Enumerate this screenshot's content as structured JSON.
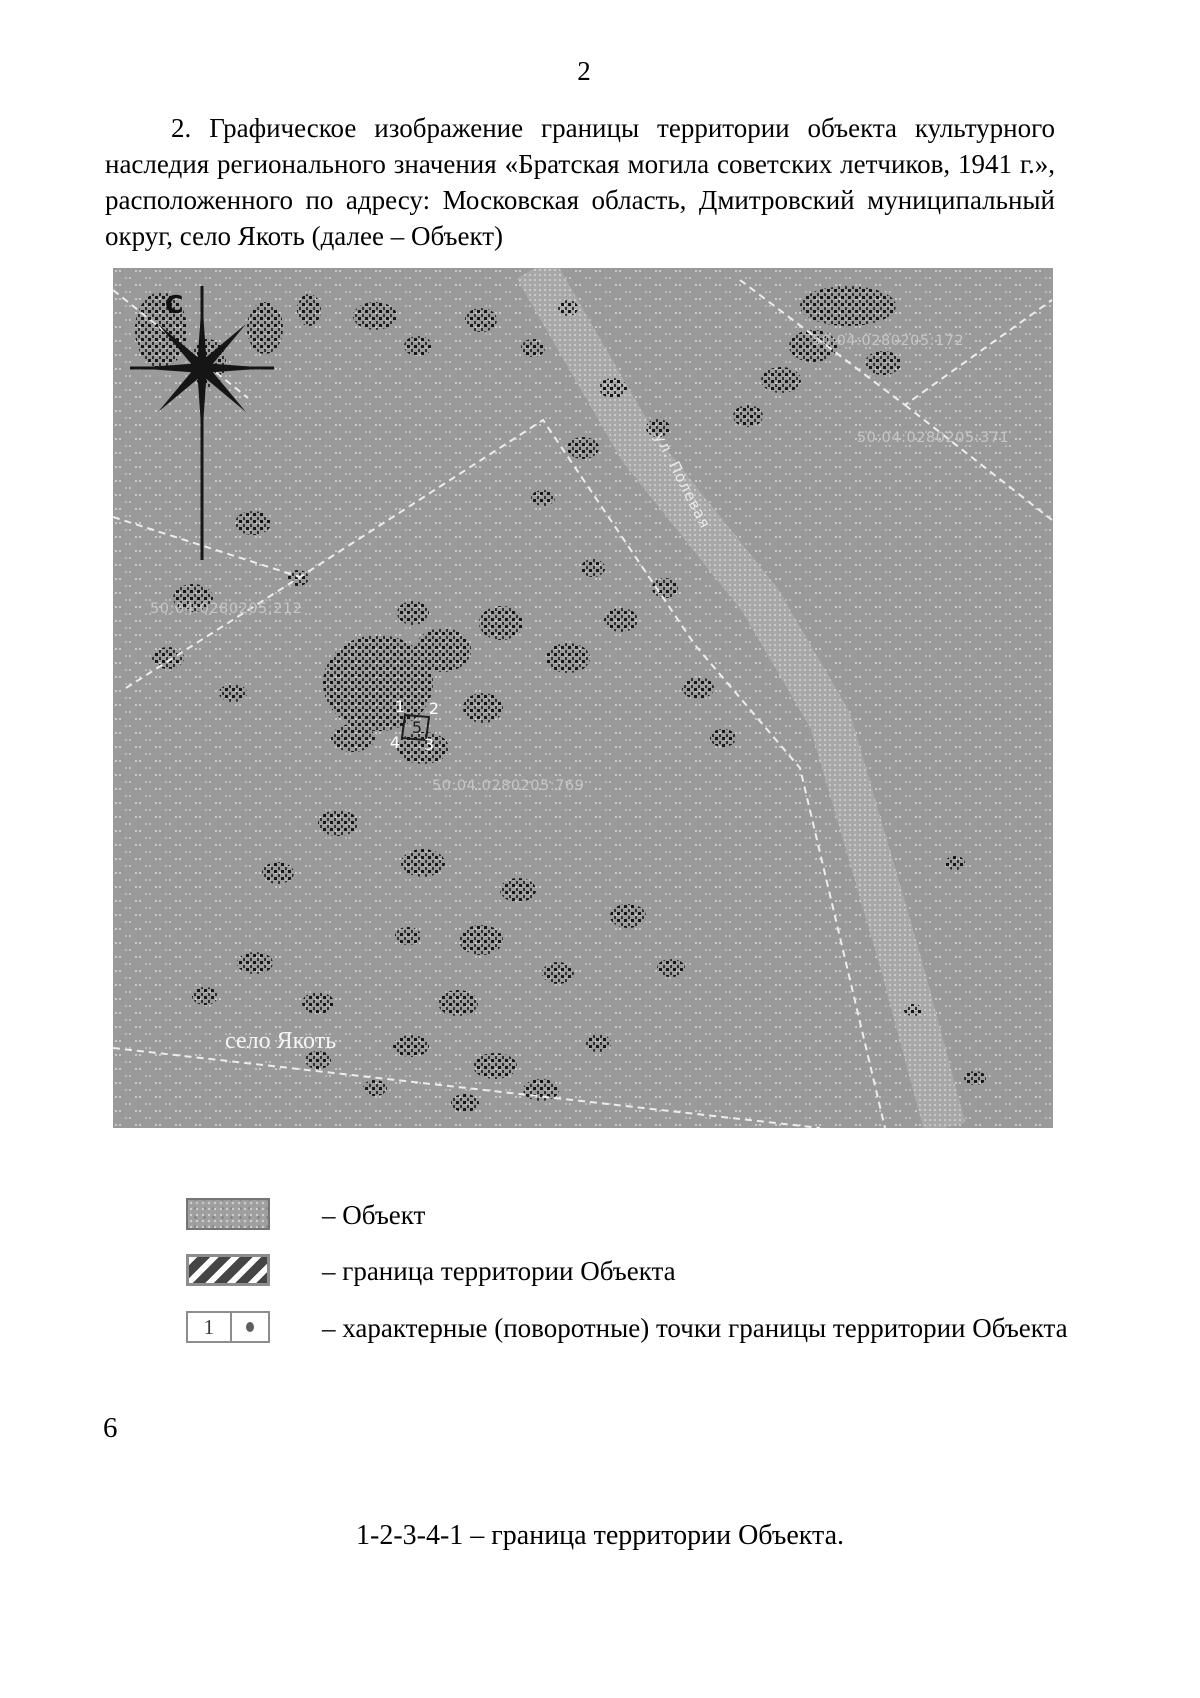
{
  "page": {
    "number": "2",
    "footer_number": "6"
  },
  "paragraph": "2. Графическое изображение границы территории объекта культурного наследия регионального значения «Братская могила советских летчиков, 1941 г.», расположенного по адресу: Московская область, Дмитровский муниципальный округ, село Якоть (далее – Объект)",
  "map": {
    "compass_label": "С",
    "street_label": "ул. Полевая",
    "village_label": "село Якоть",
    "parcels": [
      "50:04:0280205:172",
      "50:04:0280205:371",
      "50:04:0280205:212",
      "50:04:0280205:769"
    ],
    "points": [
      {
        "label": "1"
      },
      {
        "label": "2"
      },
      {
        "label": "5"
      },
      {
        "label": "4"
      },
      {
        "label": "3"
      }
    ]
  },
  "legend": {
    "items": [
      {
        "label": "– Объект"
      },
      {
        "label": "– граница территории Объекта"
      },
      {
        "label": "– характерные (поворотные) точки границы территории Объекта",
        "swatch_number": "1"
      }
    ]
  },
  "caption": "1-2-3-4-1 – граница территории Объекта.",
  "colors": {
    "map_base": "#9a9a9a",
    "boundary_dash": "#ededed",
    "speckle": "#161616",
    "document_text": "#000000"
  }
}
